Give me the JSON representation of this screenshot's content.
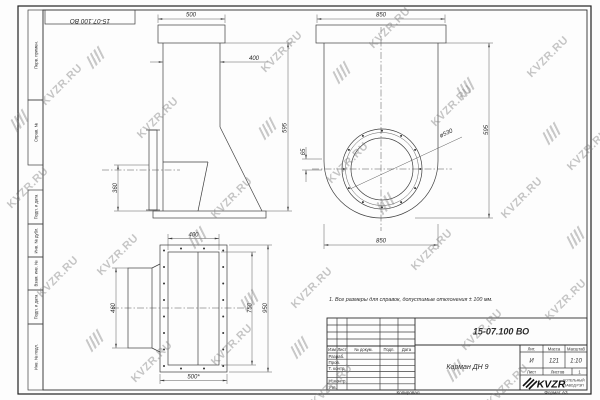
{
  "frame": {
    "margin_labels": [
      "Перв. примен.",
      "Справ. №",
      "Подп. и дата",
      "Инв. № дубл.",
      "Взам. инв. №",
      "Подп. и дата",
      "Инв. № подл."
    ],
    "top_stamp": "15-07.100 ВО",
    "footer_left": "Копировал",
    "footer_right": "Формат А3"
  },
  "views": {
    "side": {
      "dim_500": "500",
      "dim_400": "400",
      "dim_595": "595",
      "dim_360": "360"
    },
    "front": {
      "dim_850_top": "850",
      "dim_850_bottom": "850",
      "dim_595": "595",
      "dim_65": "65",
      "dim_dia": "ø530"
    },
    "plan": {
      "dim_400": "400",
      "dim_500": "500*",
      "dim_750": "750",
      "dim_950": "950",
      "dim_460": "460"
    }
  },
  "note": "1. Все размеры для справок, допустимые отклонения ± 100 мм.",
  "title_block": {
    "doc_number": "15-07.100 ВО",
    "part_name": "Карман ДН 9",
    "col_izm": "Изм",
    "col_list": "Лист",
    "col_doc": "№ докум.",
    "col_sign": "Подп.",
    "col_date": "Дата",
    "row_developed": "Разраб.",
    "row_checked": "Пров.",
    "row_tcontrol": "Т. контр.",
    "row_ncontrol": "Н. контр.",
    "row_approved": "Утв.",
    "lit_header": "Лит.",
    "mass_header": "Масса",
    "scale_header": "Масштаб",
    "lit_value": "И",
    "mass_value": "121",
    "scale_value": "1:10",
    "sheet_label": "Лист",
    "sheets_label": "Листов",
    "sheets_value": "1",
    "company_name": "KVZR",
    "company_line1": "КОТЕЛЬНЫЙ",
    "company_line2": "ЗАВОД РЭП"
  },
  "watermark": {
    "text": "KVZR.RU",
    "texts": [
      [
        62,
        85
      ],
      [
        158,
        118
      ],
      [
        282,
        52
      ],
      [
        390,
        28
      ],
      [
        548,
        57
      ],
      [
        452,
        106
      ],
      [
        28,
        188
      ],
      [
        232,
        198
      ],
      [
        348,
        163
      ],
      [
        522,
        198
      ],
      [
        118,
        255
      ],
      [
        312,
        288
      ],
      [
        432,
        250
      ],
      [
        566,
        300
      ],
      [
        58,
        277
      ],
      [
        152,
        362
      ],
      [
        332,
        385
      ],
      [
        482,
        330
      ],
      [
        232,
        345
      ],
      [
        588,
        150
      ],
      [
        508,
        385
      ]
    ],
    "logos": [
      [
        96,
        57
      ],
      [
        342,
        72
      ],
      [
        268,
        128
      ],
      [
        466,
        88
      ],
      [
        198,
        237
      ],
      [
        386,
        203
      ],
      [
        552,
        133
      ],
      [
        300,
        347
      ],
      [
        456,
        370
      ],
      [
        576,
        237
      ],
      [
        95,
        340
      ],
      [
        20,
        120
      ],
      [
        250,
        300
      ]
    ]
  }
}
